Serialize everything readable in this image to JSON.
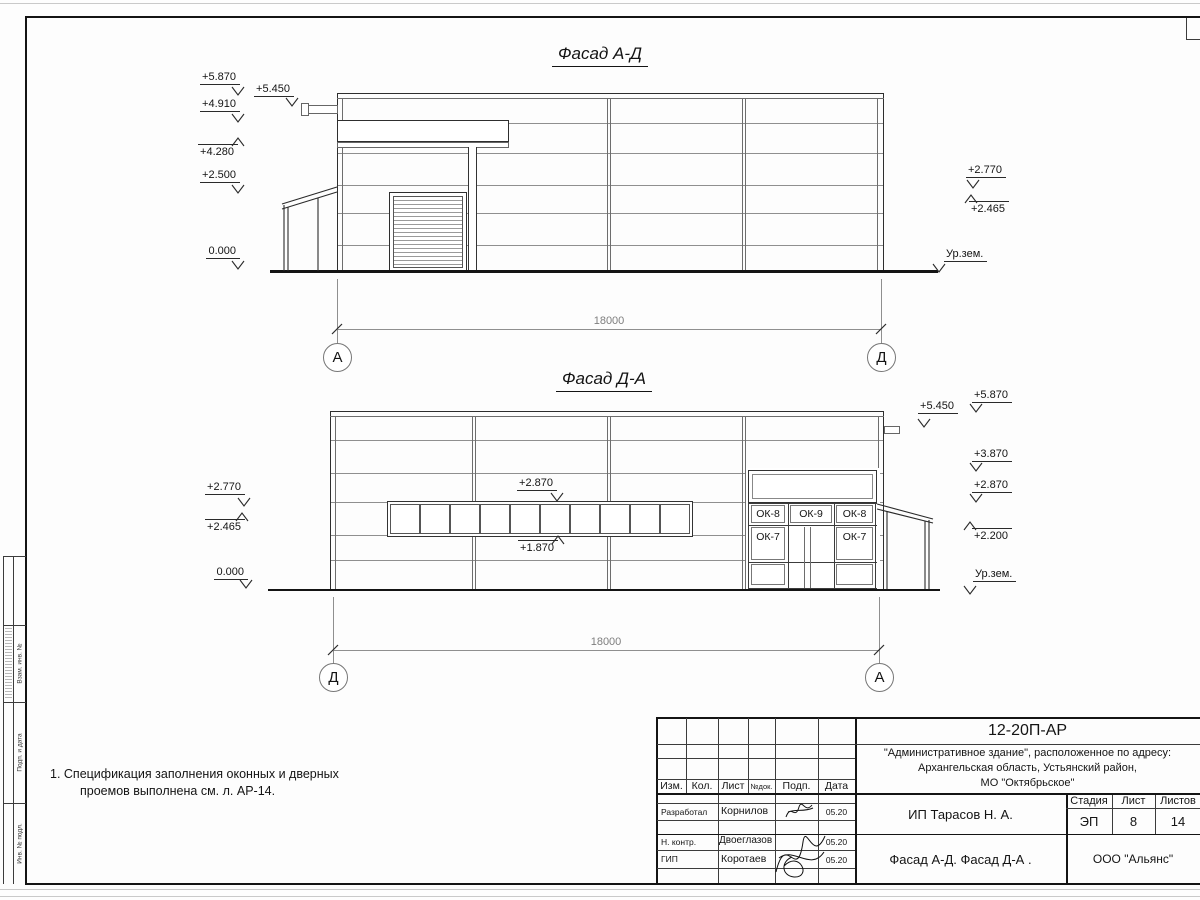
{
  "facade_top": {
    "title": "Фасад А-Д",
    "dim": "18000",
    "axis_left": "А",
    "axis_right": "Д",
    "marks_left": [
      "+5.870",
      "+4.910",
      "+4.280",
      "+2.500",
      "0.000"
    ],
    "mark_parapet": "+5.450",
    "marks_right": [
      "+2.770",
      "+2.465"
    ],
    "ground_label": "Ур.зем."
  },
  "facade_bottom": {
    "title": "Фасад Д-А",
    "dim": "18000",
    "axis_left": "Д",
    "axis_right": "А",
    "marks_left": [
      "+2.770",
      "+2.465",
      "0.000"
    ],
    "mark_window_top": "+2.870",
    "mark_window_bottom": "+1.870",
    "mark_parapet": "+5.450",
    "marks_right": [
      "+5.870",
      "+3.870",
      "+2.870",
      "+2.200"
    ],
    "ground_label": "Ур.зем.",
    "windows": {
      "w1": "ОК-8",
      "w2": "ОК-9",
      "w3": "ОК-8",
      "w4": "ОК-7",
      "w5": "ОК-7"
    }
  },
  "note": {
    "line1": "1. Спецификация заполнения оконных и дверных",
    "line2": "проемов выполнена см. л. АР-14."
  },
  "title_block": {
    "code": "12-20П-АР",
    "address1": "\"Административное здание\", расположенное по адресу:",
    "address2": "Архангельская область, Устьянский район,",
    "address3": "МО \"Октябрьское\"",
    "client": "ИП Тарасов Н. А.",
    "sheet_title": "Фасад А-Д. Фасад Д-А .",
    "org": "ООО \"Альянс\"",
    "stage_label": "Стадия",
    "sheet_label": "Лист",
    "sheets_label": "Листов",
    "stage": "ЭП",
    "sheet_no": "8",
    "sheets_total": "14",
    "col_izm": "Изм.",
    "col_kol": "Кол.",
    "col_list": "Лист",
    "col_doc": "№док.",
    "col_sign": "Подп.",
    "col_date": "Дата",
    "row1_role": "Разработал",
    "row1_name": "Корнилов",
    "row1_date": "05.20",
    "row2_role": "Н. контр.",
    "row2_name": "Двоеглазов",
    "row2_date": "05.20",
    "row3_role": "ГИП",
    "row3_name": "Коротаев",
    "row3_date": "05.20"
  },
  "margin": {
    "label1": "Взам. инв. №",
    "label2": "Подп. и дата",
    "label3": "Инв. № подл."
  }
}
